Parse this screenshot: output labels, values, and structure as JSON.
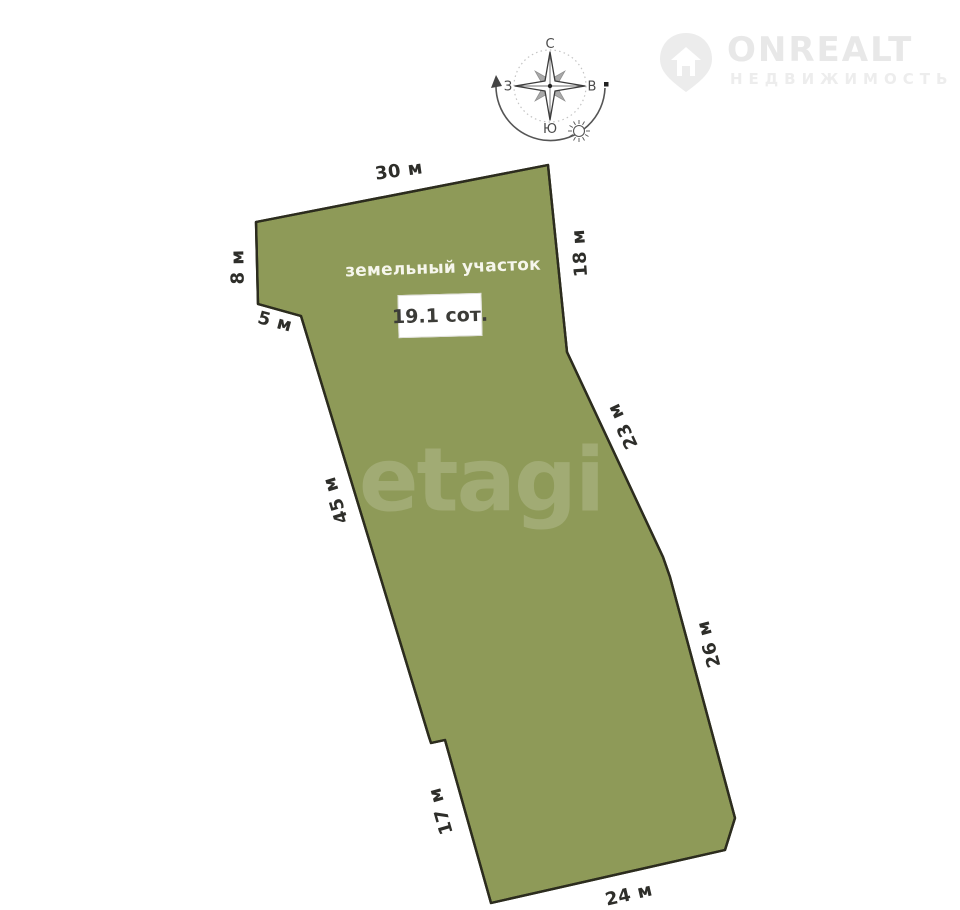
{
  "branding": {
    "logo_text": "ONREALT",
    "logo_subtitle": "НЕДВИЖИМОСТЬ"
  },
  "compass": {
    "north": "С",
    "south": "Ю",
    "east": "В",
    "west": "З"
  },
  "plot": {
    "name_label": "земельный участок",
    "area_label": "19.1 сот.",
    "watermark": "etagi",
    "fill_color": "#8e9a58",
    "border_color": "#2c2c1e",
    "dimensions": [
      {
        "side": "top",
        "label": "30 м"
      },
      {
        "side": "right-upper",
        "label": "18 м"
      },
      {
        "side": "left-upper",
        "label": "8 м"
      },
      {
        "side": "left-notch",
        "label": "5 м"
      },
      {
        "side": "left-middle",
        "label": "45 м"
      },
      {
        "side": "right-middle",
        "label": "23 м"
      },
      {
        "side": "right-lower",
        "label": "26 м"
      },
      {
        "side": "left-lower",
        "label": "17 м"
      },
      {
        "side": "bottom",
        "label": "24 м"
      }
    ]
  }
}
